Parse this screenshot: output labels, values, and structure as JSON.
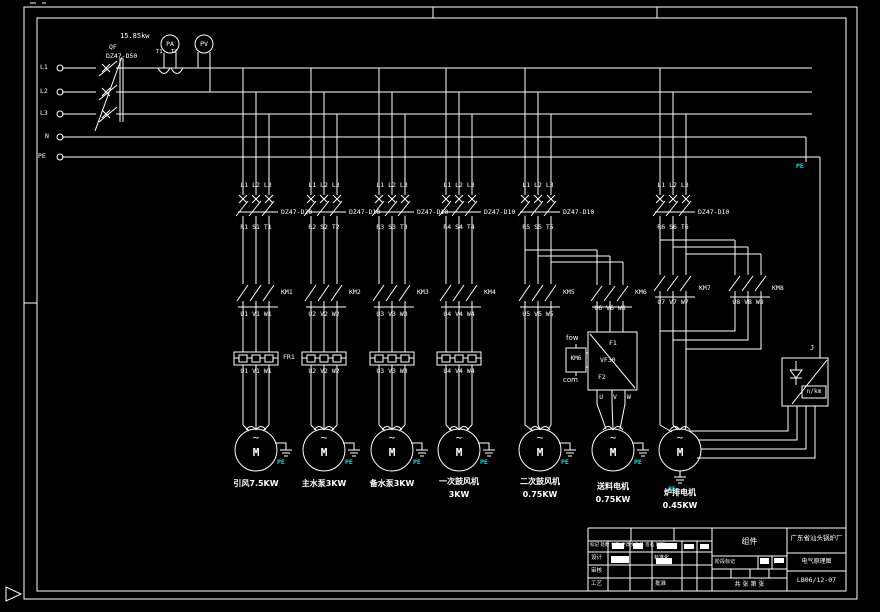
{
  "incoming": {
    "power": "15.85kw",
    "name": "QF",
    "model": "DZ47-D50"
  },
  "buses": {
    "l1": "L1",
    "l2": "L2",
    "l3": "L3",
    "n": "N",
    "pe": "PE"
  },
  "meters": {
    "ammeter": "PA",
    "voltmeter": "PV",
    "ct1": "T1",
    "ct2": "T2"
  },
  "symbols": {
    "motor": "M",
    "sine": "~"
  },
  "branches": [
    {
      "phases": "L1 L2 L3",
      "breaker": "DZ47-D20",
      "inlet": "R1 S1 T1",
      "contactor": "KM1",
      "outlet": "U1 V1 W1",
      "relay": "FR1",
      "lower": "U1 V1 W1",
      "pe": "PE",
      "label1": "引风7.5KW",
      "label2": ""
    },
    {
      "phases": "L1 L2 L3",
      "breaker": "DZ47-D10",
      "inlet": "R2 S2 T2",
      "contactor": "KM2",
      "outlet": "U2 V2 W2",
      "lower": "U2 V2 W2",
      "pe": "PE",
      "label1": "主水泵3KW",
      "label2": ""
    },
    {
      "phases": "L1 L2 L3",
      "breaker": "DZ47-D10",
      "inlet": "R3 S3 T3",
      "contactor": "KM3",
      "outlet": "U3 V3 W3",
      "lower": "U3 V3 W3",
      "pe": "PE",
      "label1": "备水泵3KW",
      "label2": ""
    },
    {
      "phases": "L1 L2 L3",
      "breaker": "DZ47-D10",
      "inlet": "R4 S4 T4",
      "contactor": "KM4",
      "outlet": "U4 V4 W4",
      "lower": "U4 V4 W4",
      "pe": "PE",
      "label1": "一次鼓风机",
      "label2": "3KW"
    },
    {
      "phases": "L1 L2 L3",
      "breaker": "DZ47-D10",
      "inlet": "R5 S5 T5",
      "contactor": "KM5",
      "outlet": "U5 V5 W5",
      "pe": "PE",
      "label1": "二次鼓风机",
      "label2": "0.75KW"
    },
    {
      "contactor": "KM6",
      "outlet": "U6 V6 W6",
      "pe": "PE",
      "label1": "送料电机",
      "label2": "0.75KW"
    },
    {
      "phases": "L1 L2 L3",
      "breaker": "DZ47-D10",
      "inlet": "R6 S6 T6",
      "contactor": "KM7",
      "contactor2": "KM8",
      "outlet": "U7 V7 W7",
      "outlet2": "U8 V8 W8",
      "pe": "PE",
      "label1": "炉排电机",
      "label2": "0.45KW"
    }
  ],
  "vfd": {
    "t_top": "F1",
    "model": "VF30",
    "t_bottom": "F2",
    "aux": "KM6",
    "fwd": "fow",
    "com": "com",
    "out": "U V W"
  },
  "controller": {
    "junction": "J",
    "tag": "n/km"
  },
  "pe_right": "PE",
  "title_block": {
    "company": "广东省汕头锅炉厂",
    "part_label": "组件",
    "drawing_title": "电气原理图",
    "drawing_no": "LB06/12-07",
    "stage_label": "阶段标记",
    "sheet_label": "共 张 第 张",
    "rev_cols": "标记 处数 分区 更改文件号 签名 日期",
    "row_design": "设计",
    "row_check": "审核",
    "row_process": "工艺",
    "col_std": "标准化",
    "col_approve": "批准"
  },
  "colors": {
    "line": "#ffffff",
    "pe_text": "#00e0e0",
    "bg": "#000000"
  }
}
